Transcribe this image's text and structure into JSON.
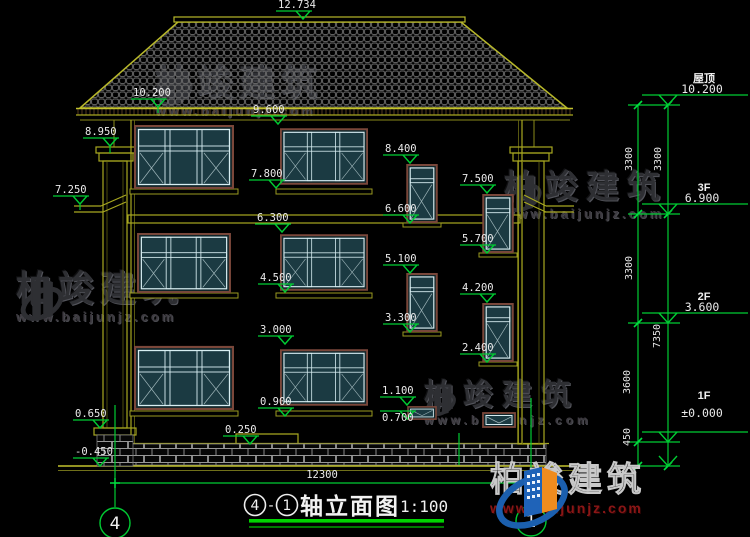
{
  "watermark": {
    "brand": "柏竣建筑",
    "url": "www.baijunjz.com"
  },
  "title": {
    "axis_from": "4",
    "separator": "-",
    "axis_to": "1",
    "name": "轴立面图",
    "scale": "1:100"
  },
  "axes": {
    "left_bubble": "4",
    "right_bubble": "1"
  },
  "dimensions": {
    "total_width": "12300",
    "segments_inner": {
      "roof_to_3f": "3300",
      "f3_to_2f": "3300",
      "f2_to_1f": "3600",
      "below_ground": "450"
    },
    "segments_outer": {
      "roof_to_3f": "3300",
      "f3_to_ground": "7350"
    }
  },
  "levels": {
    "roof": {
      "name": "屋顶",
      "value": "10.200"
    },
    "f3": {
      "name": "3F",
      "value": "6.900"
    },
    "f2": {
      "name": "2F",
      "value": "3.600"
    },
    "f1": {
      "name": "1F",
      "value": "±0.000"
    }
  },
  "marks": {
    "ridge": "12.734",
    "eave_left": "10.200",
    "win3f_top": "9.600",
    "pillar_top": "8.950",
    "stair_a1_top": "8.400",
    "win3f_bottom": "7.800",
    "stair_b1_top": "7.500",
    "bracket": "7.250",
    "stair_a1_bottom": "6.600",
    "win2f_top": "6.300",
    "stair_b1_bottom": "5.700",
    "stair_a2_top": "5.100",
    "win2f_bottom": "4.500",
    "stair_b2_top": "4.200",
    "stair_a2_bottom": "3.300",
    "win1f_top": "3.000",
    "stair_b2_bottom": "2.400",
    "small_win_top": "1.100",
    "win1f_bottom": "0.900",
    "small_win_bottom": "0.700",
    "pillar_base": "0.650",
    "porch_step": "0.250",
    "ground": "-0.450"
  },
  "colors": {
    "dim_green": "#00cc33",
    "line_yellow": "#a8a820",
    "glass_teal": "#1b3a42",
    "frame_brown": "#7a473a",
    "logo_blue": "#1b5fae",
    "logo_orange": "#f08c1e",
    "url_red": "#8a1616"
  }
}
